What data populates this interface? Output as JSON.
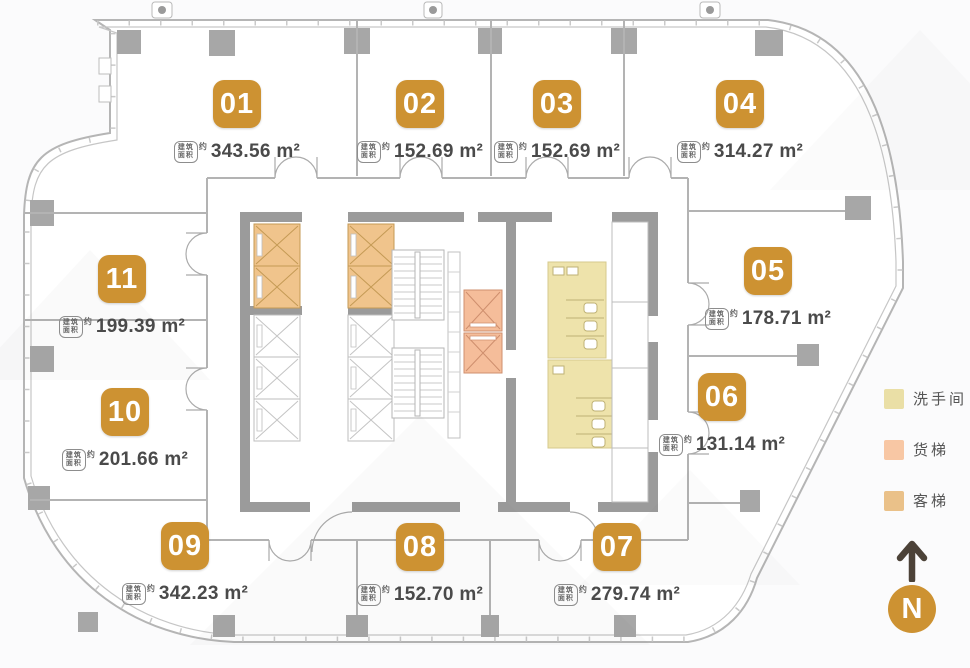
{
  "units": [
    {
      "number": "01",
      "area": "343.56 m²"
    },
    {
      "number": "02",
      "area": "152.69 m²"
    },
    {
      "number": "03",
      "area": "152.69 m²"
    },
    {
      "number": "04",
      "area": "314.27 m²"
    },
    {
      "number": "05",
      "area": "178.71 m²"
    },
    {
      "number": "06",
      "area": "131.14 m²"
    },
    {
      "number": "07",
      "area": "279.74 m²"
    },
    {
      "number": "08",
      "area": "152.70 m²"
    },
    {
      "number": "09",
      "area": "342.23 m²"
    },
    {
      "number": "10",
      "area": "201.66 m²"
    },
    {
      "number": "11",
      "area": "199.39 m²"
    }
  ],
  "labels": {
    "area_badge_top": "建筑",
    "area_badge_bottom": "面积",
    "approx": "约"
  },
  "legend": {
    "items": [
      {
        "key": "restroom",
        "label": "洗手间",
        "color": "#eadfa6"
      },
      {
        "key": "freight-elevator",
        "label": "货梯",
        "color": "#f8c7a4"
      },
      {
        "key": "passenger-elevator",
        "label": "客梯",
        "color": "#eac189"
      }
    ]
  },
  "compass": {
    "label": "N"
  },
  "colors": {
    "accent": "#cd9232",
    "wall": "#9b9b9b",
    "thin-wall": "#b3b3b3",
    "column": "#a7a7a7",
    "restroom": "#eee3ab",
    "freight": "#f5bd9a",
    "passenger": "#f0c48c",
    "arrow": "#4c4238",
    "area-text": "#4a4a4a"
  }
}
